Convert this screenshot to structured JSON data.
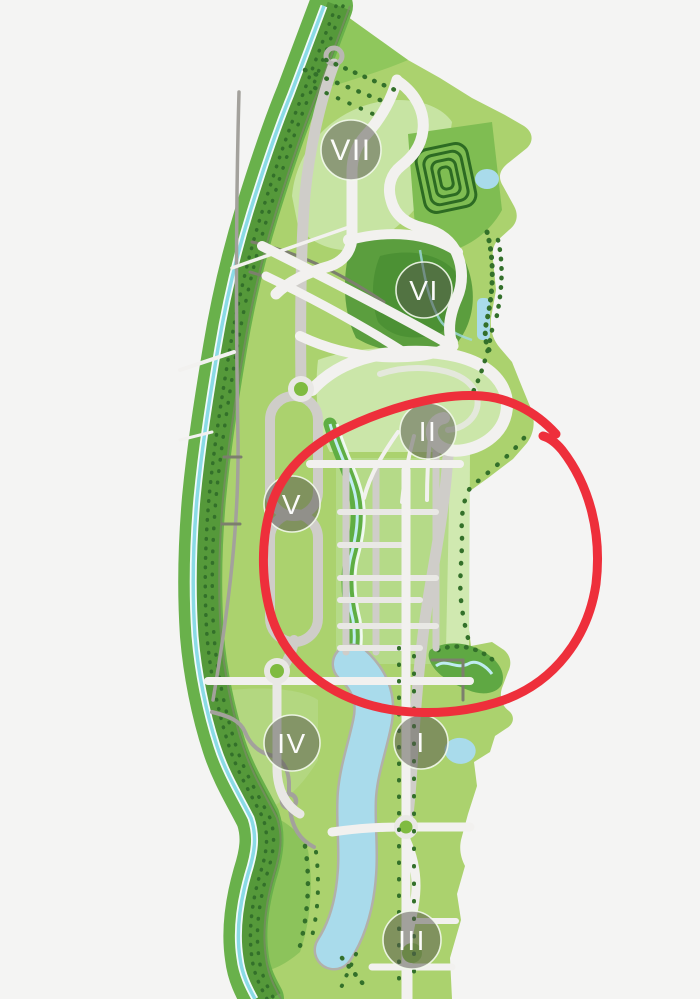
{
  "map": {
    "zones": [
      {
        "id": "zone-7",
        "label": "VII"
      },
      {
        "id": "zone-6",
        "label": "VI"
      },
      {
        "id": "zone-2",
        "label": "II"
      },
      {
        "id": "zone-5",
        "label": "V"
      },
      {
        "id": "zone-4",
        "label": "IV"
      },
      {
        "id": "zone-1",
        "label": "I"
      },
      {
        "id": "zone-3",
        "label": "III"
      }
    ],
    "annotation": {
      "type": "hand-drawn-circle",
      "color": "#ee2f3b",
      "around_zone": "II"
    },
    "colors": {
      "page_bg": "#f4f4f3",
      "map_base": "#abd26e",
      "map_light": "#c7e4a3",
      "forest_band": "#69b14b",
      "tree": "#33702a",
      "water": "#a9dbeb",
      "stream": "#8adbe6",
      "road_white": "#f2f1ef",
      "road_gray": "#cfcdc9",
      "annotation": "#ee2f3b",
      "badge_text": "#ffffff"
    }
  }
}
